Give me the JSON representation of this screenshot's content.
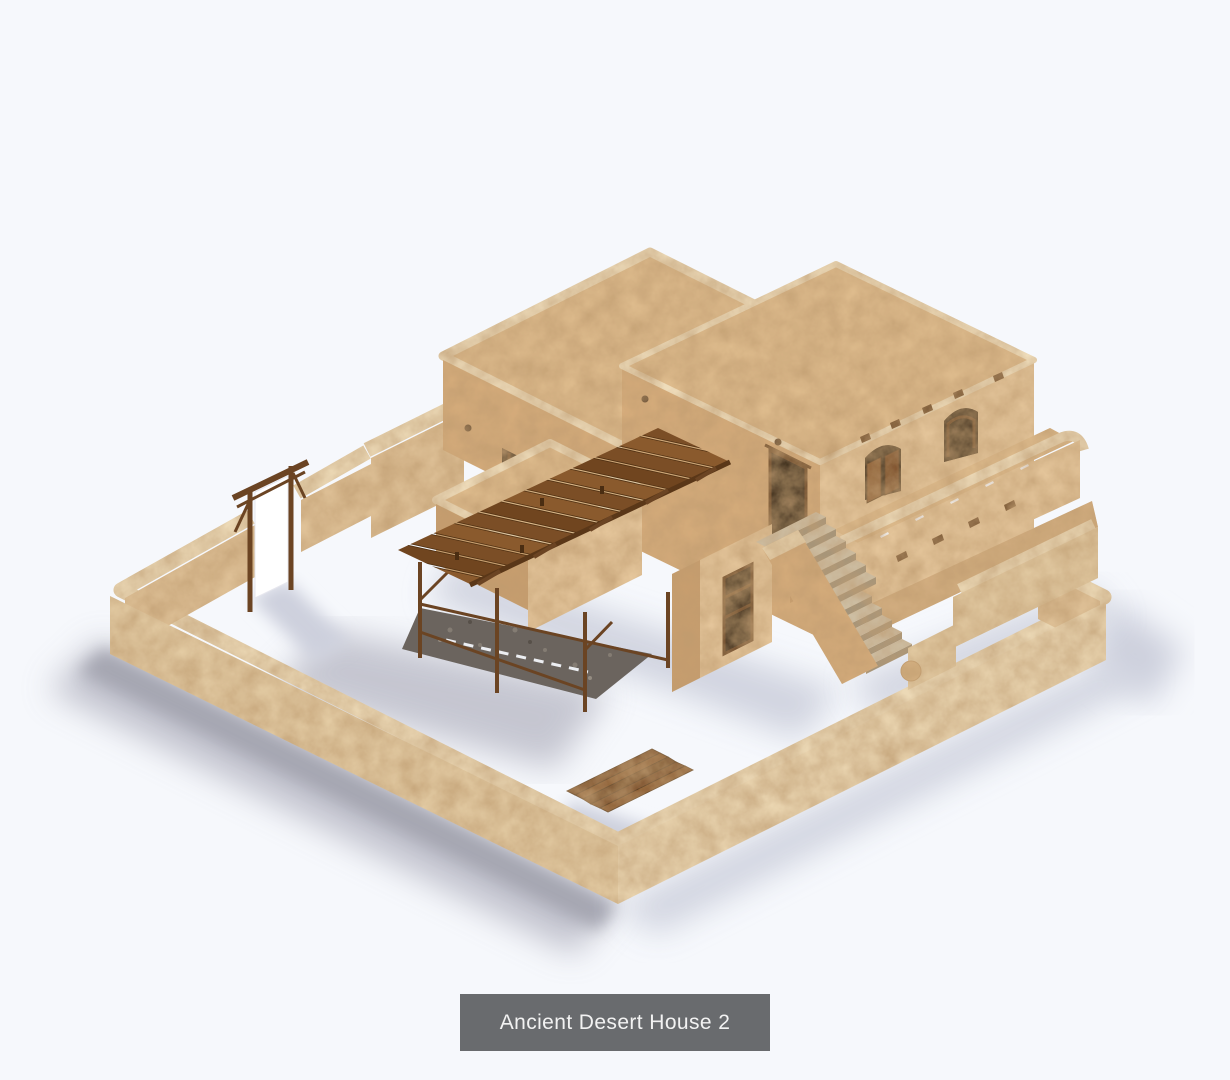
{
  "page": {
    "width": 1230,
    "height": 1080,
    "background_color": "#f6f8fc"
  },
  "caption": {
    "label": "Ancient Desert House 2",
    "background_color": "#696b6e",
    "text_color": "#f2f2f2"
  },
  "scene": {
    "title": "Ancient Desert House 2",
    "type": "isometric 3D model render of an adobe desert house compound",
    "palette": {
      "background": "#f6f8fc",
      "wall_top": "#ecd9b6",
      "wall_outer": "#e3cba3",
      "wall_outer_light": "#ead5b0",
      "wall_inner": "#dfc197",
      "roof": "#debb8d",
      "roof_rim": "#eedcba",
      "face_sw": "#d5ac7c",
      "face_se": "#e5c69b",
      "face_dark": "#c89e6e",
      "wood": "#6b4423",
      "plank_a": "#7b4e26",
      "plank_b": "#8a5a2d",
      "plank_c": "#70451f",
      "opening": "#20150c",
      "banner": "#ffffff",
      "step_tread": "#cfc2a9",
      "step_riser": "#a2947b",
      "cobblestone": "#6b645e",
      "shadow_strong": "#a2a3ae",
      "shadow_mid": "#b9bac6",
      "shadow_soft": "#cdd0dd"
    },
    "parts": [
      "perimeter-wall",
      "entry-gate-banner",
      "back-building",
      "main-two-story-building",
      "front-low-building",
      "wood-pergola",
      "cobblestone-patio",
      "stone-staircase",
      "roof-terrace",
      "right-terrace",
      "plank-deck"
    ]
  }
}
